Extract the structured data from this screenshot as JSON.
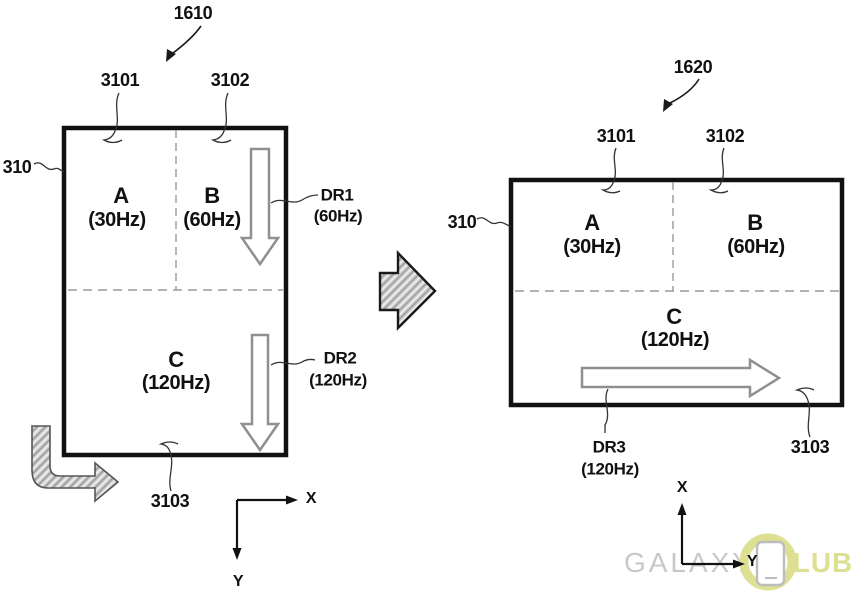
{
  "diagram": {
    "left_figure": {
      "label": "1610",
      "screen_ref": "310",
      "region_refs": {
        "top_left": "3101",
        "top_right": "3102",
        "bottom": "3103"
      },
      "regions": {
        "a": {
          "name": "A",
          "rate": "(30Hz)"
        },
        "b": {
          "name": "B",
          "rate": "(60Hz)"
        },
        "c": {
          "name": "C",
          "rate": "(120Hz)"
        }
      },
      "scan_arrows": {
        "dr1": {
          "name": "DR1",
          "rate": "(60Hz)"
        },
        "dr2": {
          "name": "DR2",
          "rate": "(120Hz)"
        }
      },
      "axes": {
        "x": "X",
        "y": "Y"
      }
    },
    "right_figure": {
      "label": "1620",
      "screen_ref": "310",
      "region_refs": {
        "top_left": "3101",
        "top_right": "3102",
        "bottom": "3103"
      },
      "regions": {
        "a": {
          "name": "A",
          "rate": "(30Hz)"
        },
        "b": {
          "name": "B",
          "rate": "(60Hz)"
        },
        "c": {
          "name": "C",
          "rate": "(120Hz)"
        }
      },
      "scan_arrows": {
        "dr3": {
          "name": "DR3",
          "rate": "(120Hz)"
        }
      },
      "axes": {
        "x": "X",
        "y": "Y"
      }
    },
    "watermark": {
      "prefix": "GALAXY",
      "suffix": "LUB"
    },
    "colors": {
      "accent": "#dde093",
      "watermark_gray": "#c8c8c8",
      "arrow_outline_gray": "#8f8f8f",
      "dash_gray": "#9a9a9a",
      "line_black": "#111111"
    }
  }
}
